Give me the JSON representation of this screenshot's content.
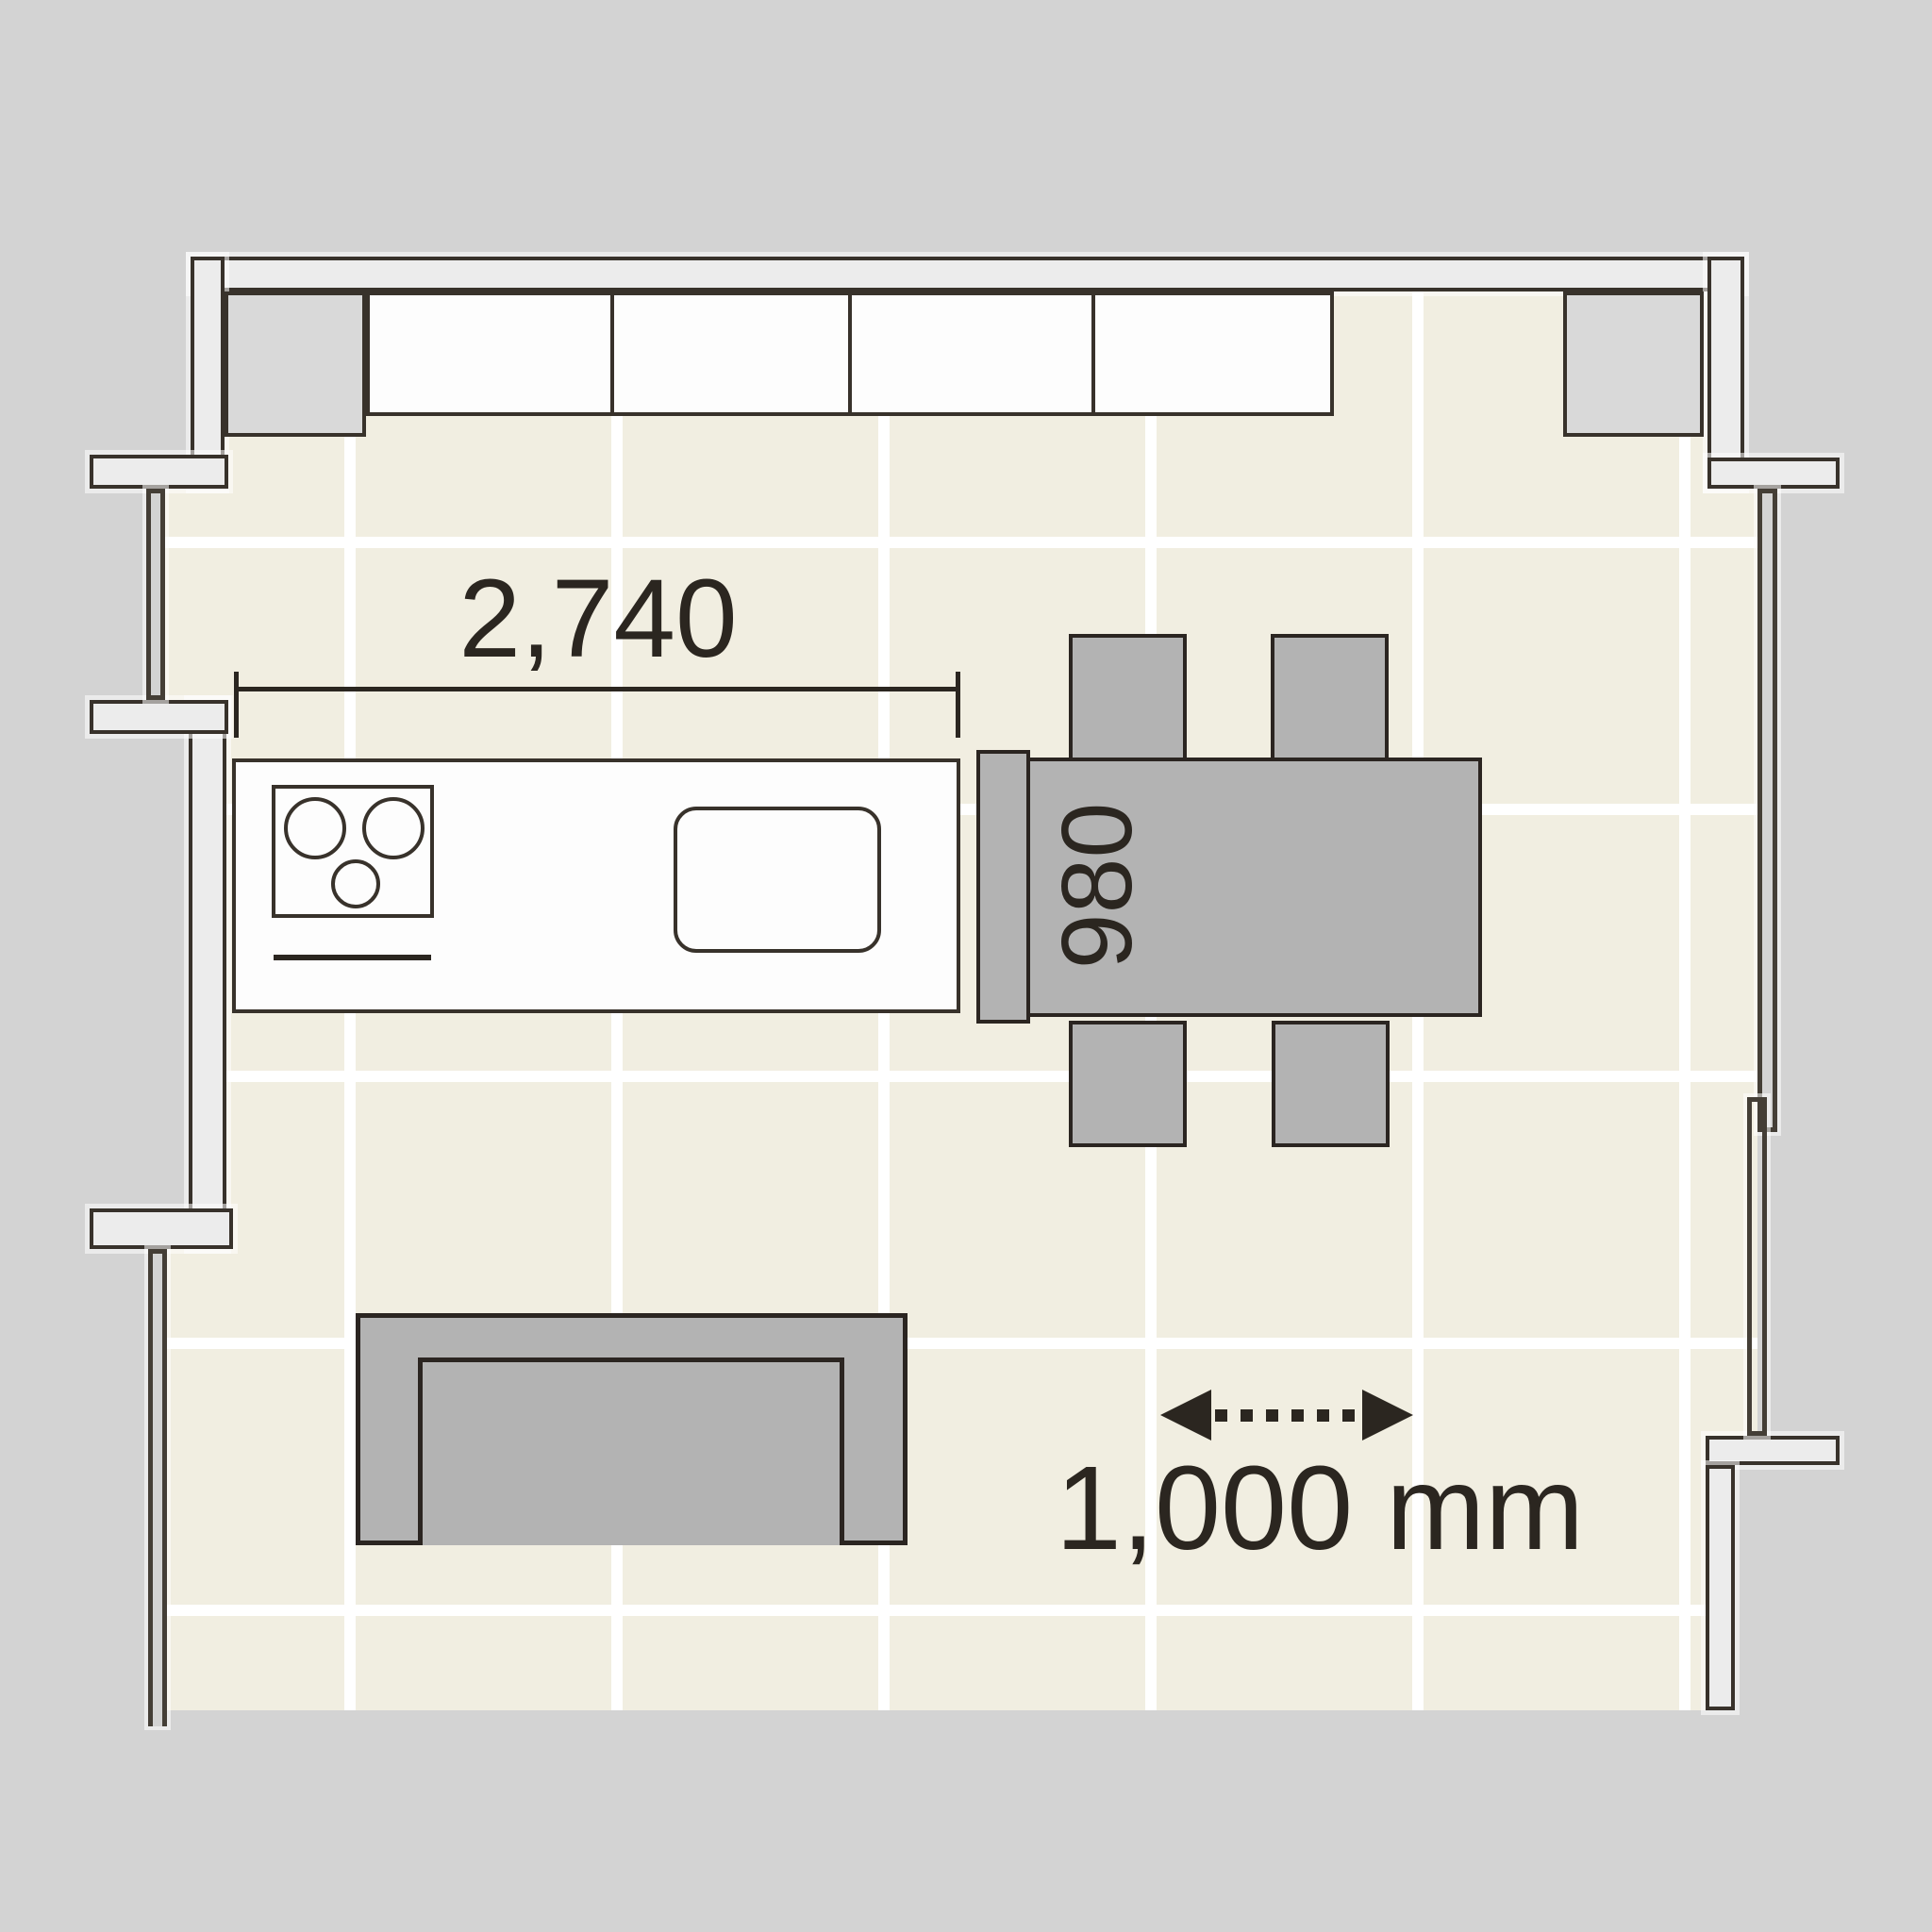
{
  "diagram": {
    "type": "floor-plan",
    "subject": "kitchen-dining room with counter, dining table, sofa and tiled floor"
  },
  "labels": {
    "counter_width": "2,740",
    "table_depth": "980",
    "clearance": "1,000 mm"
  },
  "colors": {
    "background": "#d3d3d3",
    "floor": "#f1eee1",
    "grid_line": "#ffffff",
    "wall_fill": "#ececec",
    "outline_dark": "#38322b",
    "furniture_gray": "#b3b3b3",
    "furniture_white": "#fdfdfd",
    "text": "#2b2620"
  }
}
